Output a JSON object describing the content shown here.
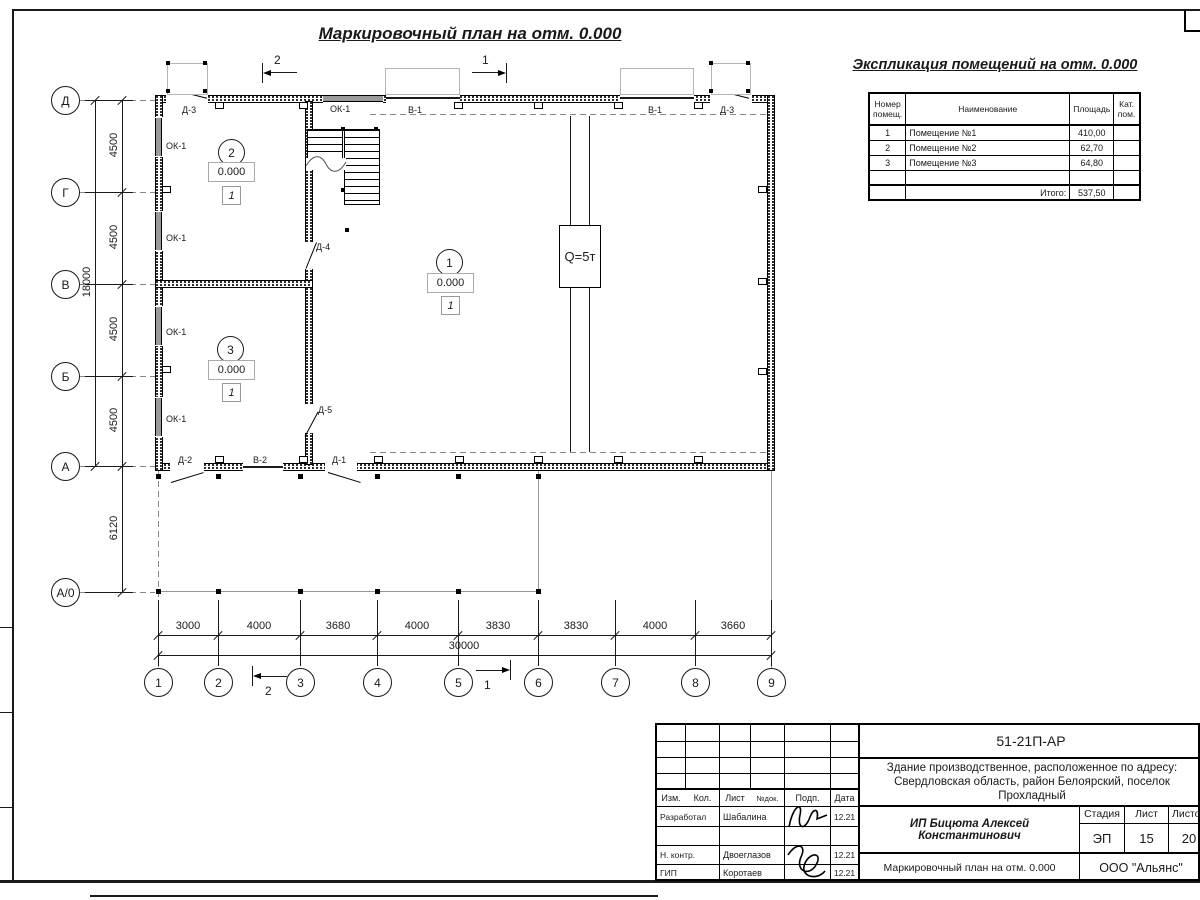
{
  "titles": {
    "main": "Маркировочный план на отм. 0.000",
    "schedule": "Экспликация помещений на отм. 0.000"
  },
  "schedule_table": {
    "headers": {
      "num": "Номер помещ.",
      "name": "Наименование",
      "area": "Площадь",
      "cat": "Кат. пом."
    },
    "rows": [
      {
        "num": "1",
        "name": "Помещение №1",
        "area": "410,00",
        "cat": ""
      },
      {
        "num": "2",
        "name": "Помещение №2",
        "area": "62,70",
        "cat": ""
      },
      {
        "num": "3",
        "name": "Помещение №3",
        "area": "64,80",
        "cat": ""
      }
    ],
    "total_label": "Итого:",
    "total_value": "537,50"
  },
  "axes": {
    "vertical": [
      "Д",
      "Г",
      "В",
      "Б",
      "А",
      "А/0"
    ],
    "horizontal": [
      "1",
      "2",
      "3",
      "4",
      "5",
      "6",
      "7",
      "8",
      "9"
    ]
  },
  "dimensions": {
    "vertical_segments": [
      "4500",
      "4500",
      "4500",
      "4500"
    ],
    "vertical_total": "18000",
    "canopy_depth": "6120",
    "horizontal_segments": [
      "3000",
      "4000",
      "3680",
      "4000",
      "3830",
      "3830",
      "4000",
      "3660"
    ],
    "horizontal_total": "30000"
  },
  "rooms": [
    {
      "number": "1",
      "elevation": "0.000",
      "floor_type": "1"
    },
    {
      "number": "2",
      "elevation": "0.000",
      "floor_type": "1"
    },
    {
      "number": "3",
      "elevation": "0.000",
      "floor_type": "1"
    }
  ],
  "marks": {
    "door_d1": "Д-1",
    "door_d2": "Д-2",
    "door_d3": "Д-3",
    "door_d4": "Д-4",
    "door_d5": "Д-5",
    "window_ok1": "ОК-1",
    "gate_v1": "В-1",
    "gate_v2": "В-2",
    "crane": "Q=5т"
  },
  "section_marks": {
    "s1": "1",
    "s2": "2"
  },
  "title_block": {
    "doc_number": "51-21П-АР",
    "project_desc": "Здание производственное, расположенное по адресу: Свердловская область, район Белоярский, поселок Прохладный",
    "object_name": "ИП Бицюта Алексей Константинович",
    "sheet_title": "Маркировочный план на отм. 0.000",
    "company": "ООО \"Альянс\"",
    "stage_label": "Стадия",
    "stage_value": "ЭП",
    "sheet_label": "Лист",
    "sheet_value": "15",
    "sheets_label": "Листов",
    "sheets_value": "20",
    "header_cols": [
      "Изм.",
      "Кол.",
      "Лист",
      "№док.",
      "Подп.",
      "Дата"
    ],
    "roles": [
      {
        "role": "Разработал",
        "name": "Шабалина",
        "date": "12.21"
      },
      {
        "role": "Н. контр.",
        "name": "Двоеглазов",
        "date": "12.21"
      },
      {
        "role": "ГИП",
        "name": "Коротаев",
        "date": "12.21"
      }
    ]
  }
}
